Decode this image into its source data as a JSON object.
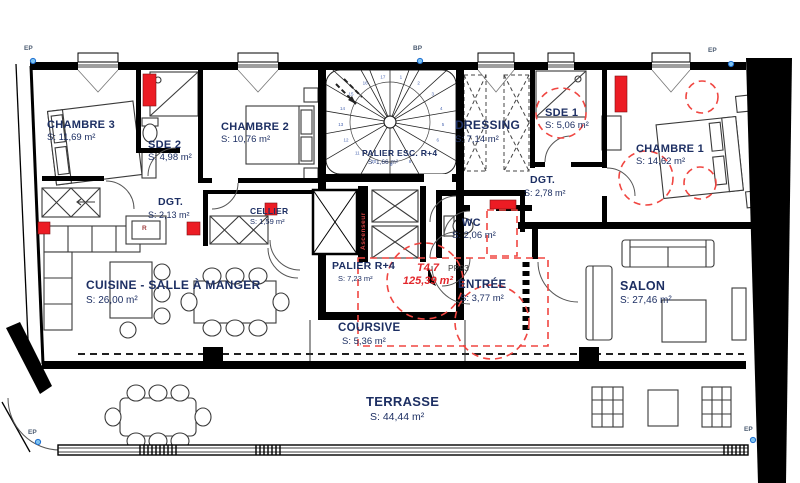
{
  "plan": {
    "title": "Plan d'étage appartement",
    "unit": {
      "code": "T4.7",
      "area": "125,39 m²"
    },
    "rooms": [
      {
        "id": "chambre-3",
        "name": "CHAMBRE 3",
        "area": "S: 11,69 m²"
      },
      {
        "id": "sde-2",
        "name": "SDE 2",
        "area": "S: 4,98 m²"
      },
      {
        "id": "chambre-2",
        "name": "CHAMBRE 2",
        "area": "S: 10,76 m²"
      },
      {
        "id": "palier-esc",
        "name": "PALIER ESC. R+4",
        "area": "S: 1,66 m²"
      },
      {
        "id": "dressing",
        "name": "DRESSING",
        "area": "S: 7,14 m²"
      },
      {
        "id": "sde-1",
        "name": "SDE 1",
        "area": "S: 5,06 m²"
      },
      {
        "id": "chambre-1",
        "name": "CHAMBRE 1",
        "area": "S: 14,62 m²"
      },
      {
        "id": "dgt-nord",
        "name": "DGT.",
        "area": "S: 2,13 m²"
      },
      {
        "id": "dgt-est",
        "name": "DGT.",
        "area": "S: 2,78 m²"
      },
      {
        "id": "cellier",
        "name": "CELLIER",
        "area": "S: 1,59 m²"
      },
      {
        "id": "wc",
        "name": "WC",
        "area": "S: 2,06 m²"
      },
      {
        "id": "palier-r4",
        "name": "PALIER R+4",
        "area": "S: 7,23 m²"
      },
      {
        "id": "entree",
        "name": "ENTRÉE",
        "area": "S: 3,77 m²"
      },
      {
        "id": "cuisine-sam",
        "name": "CUISINE - SALLE À MANGER",
        "area": "S: 26,00 m²"
      },
      {
        "id": "salon",
        "name": "SALON",
        "area": "S: 27,46 m²"
      },
      {
        "id": "coursive",
        "name": "COURSIVE",
        "area": "S: 5,36 m²"
      },
      {
        "id": "terrasse",
        "name": "TERRASSE",
        "area": "S: 44,44 m²"
      }
    ],
    "annotations": {
      "door_ref": "PP93",
      "elevator": "Ascenseur",
      "fridge": "R"
    },
    "markers": {
      "ep": "EP",
      "bp": "BP"
    },
    "stair_treads": [
      "1",
      "2",
      "3",
      "4",
      "5",
      "6",
      "7",
      "8",
      "9",
      "10",
      "11",
      "12",
      "13",
      "14",
      "15",
      "16",
      "17"
    ],
    "colors": {
      "label_text": "#1d2f63",
      "red_solid": "#ec1c24",
      "red_dashed": "#f04641",
      "marker_blue": "#1f6fd0",
      "wall": "#000000"
    }
  }
}
